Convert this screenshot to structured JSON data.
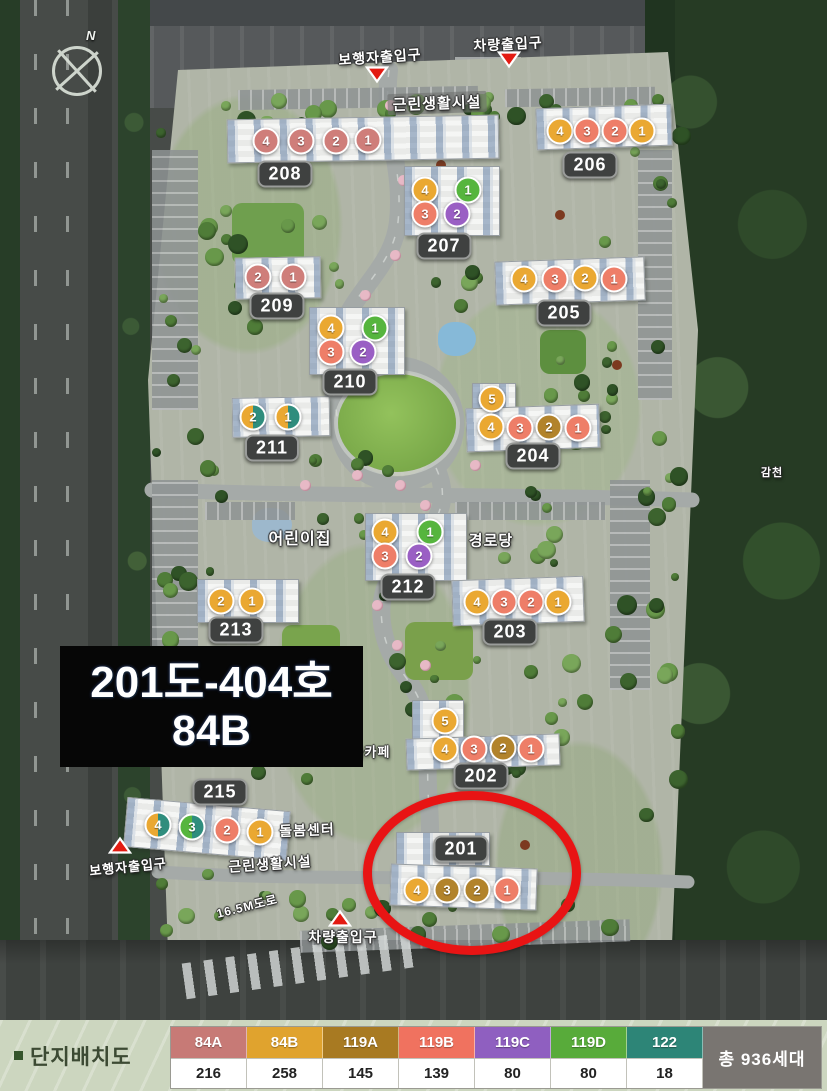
{
  "map": {
    "compass_label": "N",
    "overlay": {
      "line1": "201도-404호",
      "line2": "84B"
    },
    "type_colors": {
      "84A": "#cf7e7a",
      "84B": "#eaa832",
      "119A": "#b2832b",
      "119B": "#ee7e68",
      "119C": "#9a5fc4",
      "119D": "#56b53e",
      "122": "#2f8d7d"
    },
    "buildings": [
      {
        "label": "208",
        "lx": 285,
        "ly": 174,
        "rects": [
          [
            227,
            117,
            270,
            42,
            -1
          ]
        ],
        "units": [
          {
            "n": "4",
            "t": "84A",
            "x": 266,
            "y": 141
          },
          {
            "n": "3",
            "t": "84A",
            "x": 301,
            "y": 141
          },
          {
            "n": "2",
            "t": "84A",
            "x": 336,
            "y": 141
          },
          {
            "n": "1",
            "t": "84A",
            "x": 368,
            "y": 140
          }
        ]
      },
      {
        "label": "206",
        "lx": 590,
        "ly": 165,
        "rects": [
          [
            536,
            106,
            134,
            40,
            -2
          ]
        ],
        "units": [
          {
            "n": "4",
            "t": "84B",
            "x": 560,
            "y": 131
          },
          {
            "n": "3",
            "t": "119B",
            "x": 587,
            "y": 131
          },
          {
            "n": "2",
            "t": "119B",
            "x": 615,
            "y": 131
          },
          {
            "n": "1",
            "t": "84B",
            "x": 642,
            "y": 131
          }
        ]
      },
      {
        "label": "207",
        "lx": 444,
        "ly": 246,
        "rects": [
          [
            404,
            166,
            94,
            68,
            0
          ]
        ],
        "units": [
          {
            "n": "4",
            "t": "84B",
            "x": 425,
            "y": 190
          },
          {
            "n": "1",
            "t": "119D",
            "x": 468,
            "y": 190
          },
          {
            "n": "3",
            "t": "119B",
            "x": 425,
            "y": 214
          },
          {
            "n": "2",
            "t": "119C",
            "x": 457,
            "y": 214
          }
        ]
      },
      {
        "label": "209",
        "lx": 277,
        "ly": 306,
        "rects": [
          [
            235,
            257,
            84,
            40,
            -1
          ]
        ],
        "units": [
          {
            "n": "2",
            "t": "84A",
            "x": 258,
            "y": 277
          },
          {
            "n": "1",
            "t": "84A",
            "x": 293,
            "y": 277
          }
        ]
      },
      {
        "label": "205",
        "lx": 564,
        "ly": 313,
        "rects": [
          [
            495,
            259,
            148,
            42,
            -2
          ]
        ],
        "units": [
          {
            "n": "4",
            "t": "84B",
            "x": 524,
            "y": 279
          },
          {
            "n": "3",
            "t": "119B",
            "x": 555,
            "y": 279
          },
          {
            "n": "2",
            "t": "84B",
            "x": 585,
            "y": 278
          },
          {
            "n": "1",
            "t": "119B",
            "x": 614,
            "y": 279
          }
        ]
      },
      {
        "label": "210",
        "lx": 350,
        "ly": 382,
        "rects": [
          [
            309,
            307,
            94,
            66,
            0
          ]
        ],
        "units": [
          {
            "n": "4",
            "t": "84B",
            "x": 331,
            "y": 328
          },
          {
            "n": "1",
            "t": "119D",
            "x": 375,
            "y": 328
          },
          {
            "n": "3",
            "t": "119B",
            "x": 331,
            "y": 352
          },
          {
            "n": "2",
            "t": "119C",
            "x": 363,
            "y": 352
          }
        ]
      },
      {
        "label": "204",
        "lx": 533,
        "ly": 456,
        "rects": [
          [
            472,
            383,
            42,
            30,
            0
          ],
          [
            466,
            406,
            132,
            42,
            -2
          ]
        ],
        "units": [
          {
            "n": "5",
            "t": "84B",
            "x": 492,
            "y": 399
          },
          {
            "n": "4",
            "t": "84B",
            "x": 491,
            "y": 427
          },
          {
            "n": "3",
            "t": "119B",
            "x": 520,
            "y": 428
          },
          {
            "n": "2",
            "t": "119A",
            "x": 549,
            "y": 427
          },
          {
            "n": "1",
            "t": "119B",
            "x": 578,
            "y": 428
          }
        ]
      },
      {
        "label": "211",
        "lx": 272,
        "ly": 448,
        "rects": [
          [
            232,
            397,
            96,
            38,
            -1
          ]
        ],
        "units": [
          {
            "n": "2",
            "t": "84B",
            "t2": "122",
            "x": 253,
            "y": 417
          },
          {
            "n": "1",
            "t": "84B",
            "t2": "122",
            "x": 288,
            "y": 417
          }
        ]
      },
      {
        "label": "212",
        "lx": 408,
        "ly": 587,
        "rects": [
          [
            365,
            513,
            100,
            66,
            0
          ]
        ],
        "units": [
          {
            "n": "4",
            "t": "84B",
            "x": 385,
            "y": 532
          },
          {
            "n": "1",
            "t": "119D",
            "x": 430,
            "y": 532
          },
          {
            "n": "3",
            "t": "119B",
            "x": 385,
            "y": 556
          },
          {
            "n": "2",
            "t": "119C",
            "x": 419,
            "y": 556
          }
        ]
      },
      {
        "label": "213",
        "lx": 236,
        "ly": 630,
        "rects": [
          [
            197,
            579,
            100,
            42,
            0
          ]
        ],
        "units": [
          {
            "n": "2",
            "t": "84B",
            "x": 221,
            "y": 601
          },
          {
            "n": "1",
            "t": "84B",
            "x": 252,
            "y": 601
          }
        ]
      },
      {
        "label": "203",
        "lx": 510,
        "ly": 632,
        "rects": [
          [
            452,
            578,
            130,
            44,
            -2
          ]
        ],
        "units": [
          {
            "n": "4",
            "t": "84B",
            "x": 477,
            "y": 602
          },
          {
            "n": "3",
            "t": "119B",
            "x": 504,
            "y": 602
          },
          {
            "n": "2",
            "t": "119B",
            "x": 531,
            "y": 602
          },
          {
            "n": "1",
            "t": "84B",
            "x": 558,
            "y": 602
          }
        ]
      },
      {
        "label": "202",
        "lx": 481,
        "ly": 776,
        "rects": [
          [
            412,
            700,
            50,
            46,
            0
          ],
          [
            406,
            736,
            152,
            30,
            -2
          ]
        ],
        "units": [
          {
            "n": "5",
            "t": "84B",
            "x": 445,
            "y": 721
          },
          {
            "n": "4",
            "t": "84B",
            "x": 445,
            "y": 749
          },
          {
            "n": "3",
            "t": "119B",
            "x": 474,
            "y": 749
          },
          {
            "n": "2",
            "t": "119A",
            "x": 503,
            "y": 748
          },
          {
            "n": "1",
            "t": "119B",
            "x": 531,
            "y": 749
          }
        ]
      },
      {
        "label": "215",
        "lx": 220,
        "ly": 792,
        "rects": [
          [
            125,
            804,
            162,
            48,
            5
          ]
        ],
        "units": [
          {
            "n": "4",
            "t": "84B",
            "t2": "122",
            "x": 158,
            "y": 825
          },
          {
            "n": "3",
            "t": "119D",
            "t2": "122",
            "x": 192,
            "y": 827
          },
          {
            "n": "2",
            "t": "119B",
            "x": 227,
            "y": 830
          },
          {
            "n": "1",
            "t": "84B",
            "x": 260,
            "y": 832
          }
        ]
      },
      {
        "label": "201",
        "lx": 461,
        "ly": 849,
        "rects": [
          [
            396,
            832,
            92,
            32,
            0
          ],
          [
            390,
            866,
            145,
            40,
            2
          ]
        ],
        "units": [
          {
            "n": "4",
            "t": "84B",
            "x": 417,
            "y": 890
          },
          {
            "n": "3",
            "t": "119A",
            "x": 447,
            "y": 890
          },
          {
            "n": "2",
            "t": "119A",
            "x": 477,
            "y": 890
          },
          {
            "n": "1",
            "t": "119B",
            "x": 507,
            "y": 890
          }
        ]
      }
    ],
    "site_labels": [
      {
        "text": "보행자출입구",
        "x": 380,
        "y": 57,
        "rot": -4,
        "size": 14,
        "chip": false
      },
      {
        "text": "차량출입구",
        "x": 508,
        "y": 44,
        "rot": -3,
        "size": 14,
        "chip": false
      },
      {
        "text": "근린생활시설",
        "x": 437,
        "y": 103,
        "rot": -2,
        "size": 15,
        "chip": true
      },
      {
        "text": "어린이집",
        "x": 300,
        "y": 537,
        "rot": 0,
        "size": 16,
        "chip": false
      },
      {
        "text": "경로당",
        "x": 491,
        "y": 540,
        "rot": 0,
        "size": 15,
        "chip": false
      },
      {
        "text": "북카페",
        "x": 371,
        "y": 751,
        "rot": 0,
        "size": 13,
        "chip": false
      },
      {
        "text": "돌봄센터",
        "x": 307,
        "y": 830,
        "rot": -2,
        "size": 14,
        "chip": false
      },
      {
        "text": "보행자출입구",
        "x": 128,
        "y": 866,
        "rot": -6,
        "size": 13,
        "chip": false
      },
      {
        "text": "근린생활시설",
        "x": 270,
        "y": 864,
        "rot": -4,
        "size": 14,
        "chip": false
      },
      {
        "text": "16.5M도로",
        "x": 247,
        "y": 906,
        "rot": -14,
        "size": 12,
        "chip": false
      },
      {
        "text": "차량출입구",
        "x": 343,
        "y": 937,
        "rot": 0,
        "size": 14,
        "chip": false
      },
      {
        "text": "감천",
        "x": 772,
        "y": 472,
        "rot": 0,
        "size": 11,
        "chip": false
      }
    ],
    "entrance_markers": [
      {
        "x": 377,
        "y": 77,
        "dir": "down"
      },
      {
        "x": 509,
        "y": 62,
        "dir": "down"
      },
      {
        "x": 120,
        "y": 848,
        "dir": "up"
      },
      {
        "x": 340,
        "y": 921,
        "dir": "up"
      }
    ]
  },
  "legend": {
    "title": "단지배치도",
    "total": "총 936세대",
    "types": [
      {
        "name": "84A",
        "count": "216",
        "color": "#c77a76"
      },
      {
        "name": "84B",
        "count": "258",
        "color": "#e0a32e"
      },
      {
        "name": "119A",
        "count": "145",
        "color": "#a87a22"
      },
      {
        "name": "119B",
        "count": "139",
        "color": "#f0725f"
      },
      {
        "name": "119C",
        "count": "80",
        "color": "#8f5fc0"
      },
      {
        "name": "119D",
        "count": "80",
        "color": "#58ab3a"
      },
      {
        "name": "122",
        "count": "18",
        "color": "#2d8577"
      }
    ]
  }
}
